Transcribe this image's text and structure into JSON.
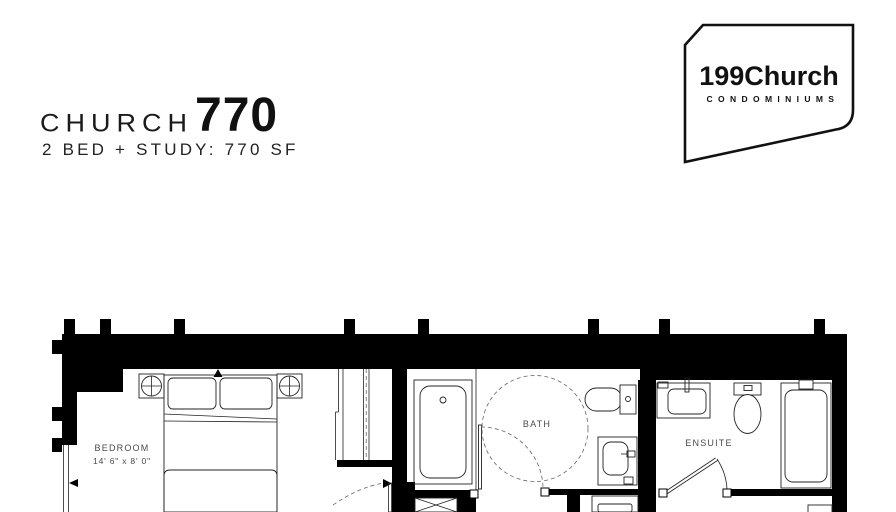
{
  "header": {
    "title_name": "CHURCH",
    "title_number": "770",
    "subtitle": "2 BED + STUDY: 770 SF"
  },
  "logo": {
    "brand": "199Church",
    "tagline": "C O N D O M I N I U M S"
  },
  "floorplan": {
    "bedroom_label": "BEDROOM",
    "bedroom_dimensions": "14' 6\" x 8' 0\"",
    "bath_label": "BATH",
    "ensuite_label": "ENSUITE"
  },
  "colors": {
    "wall": "#000000",
    "linework": "#222222",
    "label": "#4a4a4a",
    "background": "#ffffff"
  }
}
